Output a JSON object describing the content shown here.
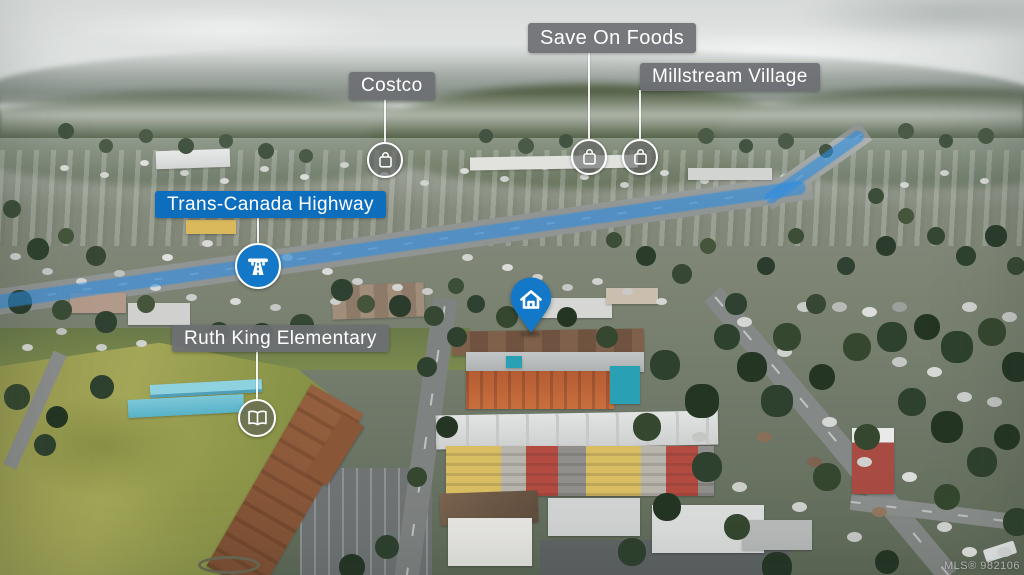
{
  "labels": {
    "save_on_foods": "Save On Foods",
    "costco": "Costco",
    "millstream_village": "Millstream Village",
    "trans_canada_highway": "Trans-Canada Highway",
    "ruth_king_elementary": "Ruth King Elementary"
  },
  "markers": {
    "save_on_foods_icon": "shopping-bag",
    "costco_icon": "shopping-bag",
    "millstream_village_icon": "shopping-bag",
    "trans_canada_highway_icon": "highway",
    "ruth_king_elementary_icon": "open-book",
    "subject_property_icon": "home-pin"
  },
  "watermark": "MLS® 982106",
  "colors": {
    "poi_label_bg": "rgba(109,111,115,0.92)",
    "highway_label_bg": "#0e6ebe",
    "marker_blue": "#1478c8",
    "marker_circle_bg": "rgba(86,88,90,0.55)",
    "highway_overlay": "rgba(45,140,222,0.62)",
    "leader_line": "rgba(255,255,255,0.9)",
    "label_text": "#ffffff"
  }
}
